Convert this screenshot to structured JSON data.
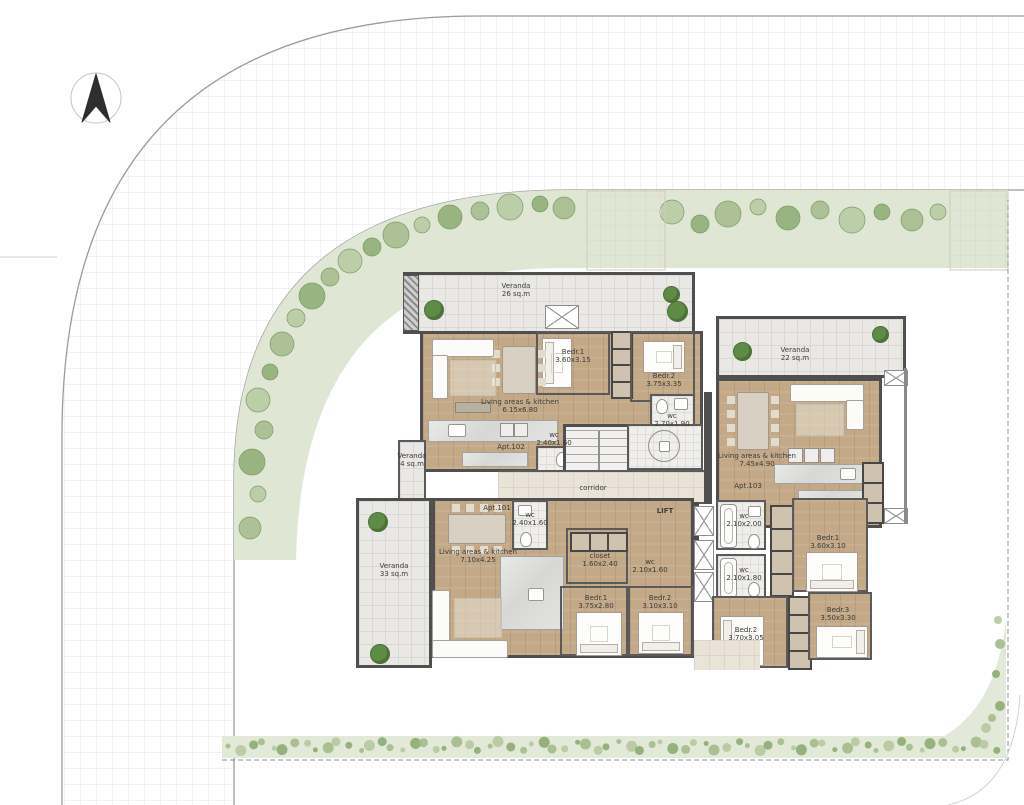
{
  "plan": {
    "corridor_label": "corridor",
    "lift_label": "LIFT",
    "apartments": {
      "apt102": {
        "id": "Apt.102",
        "veranda": {
          "name": "Veranda",
          "area": "26 sq.m"
        },
        "veranda_small": {
          "name": "Veranda",
          "area": "4 sq.m"
        },
        "living": {
          "name": "Living areas & kitchen",
          "dims": "6.15x6.80"
        },
        "bed1": {
          "name": "Bedr.1",
          "dims": "3.60x3.15"
        },
        "bed2": {
          "name": "Bedr.2",
          "dims": "3.75x3.35"
        },
        "wc1": {
          "name": "wc",
          "dims": "2.70x1.90"
        },
        "wc2": {
          "name": "wc",
          "dims": "2.40x1.60"
        }
      },
      "apt103": {
        "id": "Apt.103",
        "veranda": {
          "name": "Veranda",
          "area": "22 sq.m"
        },
        "living": {
          "name": "Living areas & kitchen",
          "dims": "7.45x4.90"
        },
        "bed1": {
          "name": "Bedr.1",
          "dims": "3.60x3.10"
        },
        "bed2": {
          "name": "Bedr.2",
          "dims": "3.70x3.05"
        },
        "bed3": {
          "name": "Bedr.3",
          "dims": "3.50x3.30"
        },
        "wc1": {
          "name": "wc",
          "dims": "2.10x2.00"
        },
        "wc2": {
          "name": "wc",
          "dims": "2.10x1.80"
        }
      },
      "apt101": {
        "id": "Apt.101",
        "veranda": {
          "name": "Veranda",
          "area": "33 sq.m"
        },
        "living": {
          "name": "Living areas & kitchen",
          "dims": "7.10x4.25"
        },
        "closet": {
          "name": "closet",
          "dims": "1.60x2.40"
        },
        "wc1": {
          "name": "wc",
          "dims": "2.40x1.60"
        },
        "wc2": {
          "name": "wc",
          "dims": "2.10x1.60"
        },
        "bed1": {
          "name": "Bedr.1",
          "dims": "3.75x2.80"
        },
        "bed2": {
          "name": "Bedr.2",
          "dims": "3.10x3.10"
        }
      }
    },
    "colors": {
      "wall": "#4f4f4f",
      "wood_floor": "#c3a987",
      "veranda_tile": "#e9e8e4",
      "walkway": "#eae3d7",
      "landscape_band": "#dfe7d4",
      "tree": "#5e8b45",
      "road_line": "#9c9c9c"
    }
  }
}
